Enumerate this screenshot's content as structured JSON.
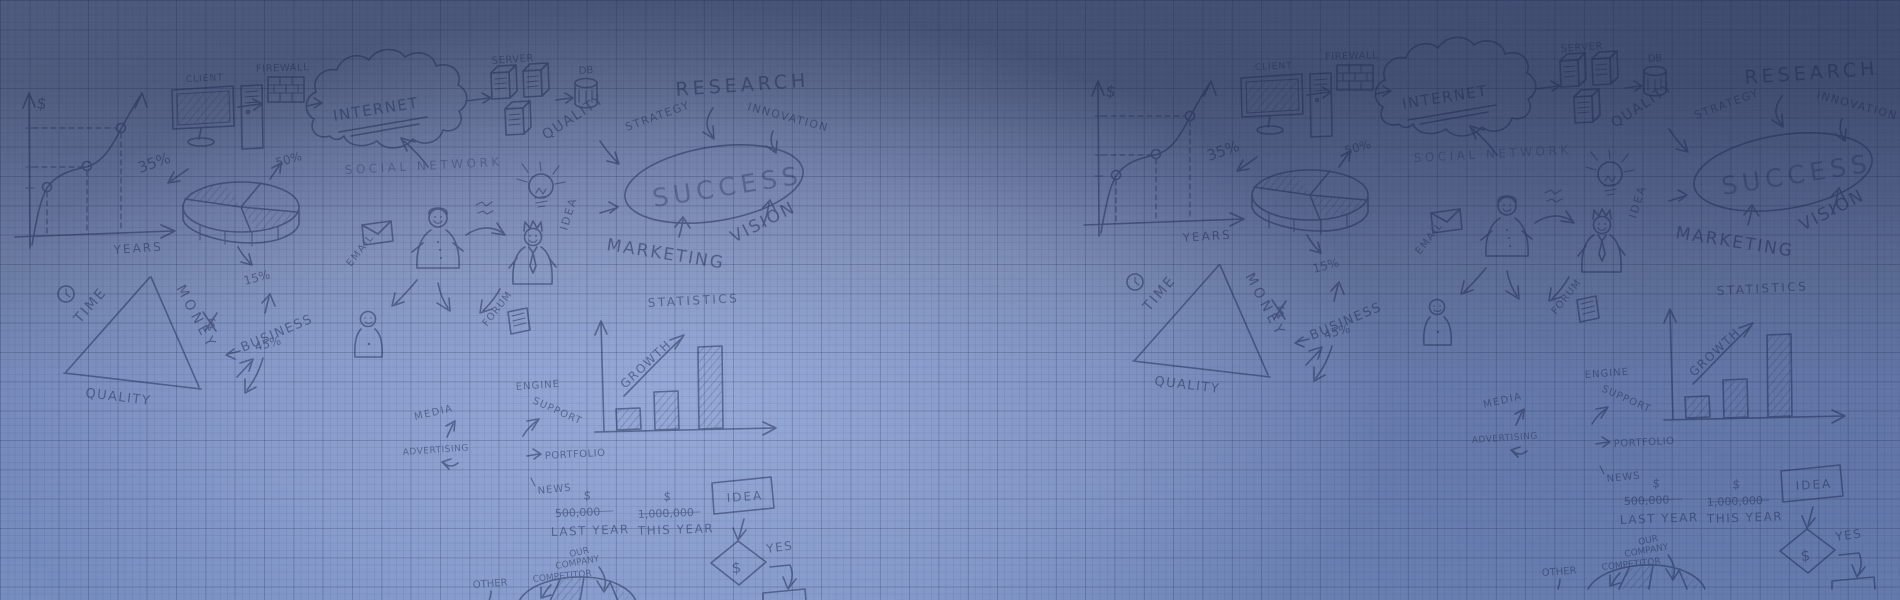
{
  "background": {
    "description": "blue graph-paper banner with hand-drawn business doodles, repeated twice",
    "colors": {
      "top": "#445177",
      "bottom": "#7089bd",
      "center_highlight": "#96a8d8",
      "grid_line": "#172142",
      "ink": "#1e2a52"
    }
  },
  "doodles": {
    "growth_chart": {
      "axis_y": "$",
      "axis_x": "YEARS",
      "pct35": "35%"
    },
    "network": {
      "client": "CLIENT",
      "firewall": "FIREWALL",
      "internet": "INTERNET",
      "server": "SERVER",
      "db": "DB",
      "social": "SOCIAL NETWORK",
      "pct50": "50%"
    },
    "concepts": {
      "quality": "QUALITY",
      "strategy": "STRATEGY",
      "research": "RESEARCH",
      "innovation": "INNOVATION",
      "success": "SUCCESS",
      "vision": "VISION",
      "marketing": "MARKETING"
    },
    "pie": {
      "pct15": "15%",
      "pct45": "45%"
    },
    "triangle": {
      "time": "TIME",
      "money": "MONEY",
      "quality": "QUALITY",
      "dollar": "$",
      "business": "BUSINESS"
    },
    "idea_bulb": {
      "idea": "IDEA"
    },
    "email": {
      "label": "EMAIL"
    },
    "forum": {
      "label": "FORUM"
    },
    "statistics": {
      "title": "STATISTICS",
      "growth": "GROWTH"
    },
    "channels": {
      "media": "MEDIA",
      "advertising": "ADVERTISING",
      "engine": "ENGINE",
      "support": "SUPPORT",
      "portfolio": "PORTFOLIO",
      "news": "NEWS"
    },
    "comparison": {
      "dollar_last": "$",
      "amount_last": "500,000",
      "label_last": "LAST YEAR",
      "dollar_this": "$",
      "amount_this": "1,000,000",
      "label_this": "THIS YEAR",
      "our_line1": "OUR",
      "our_line2": "COMPANY",
      "competitor": "COMPETITOR",
      "other": "OTHER"
    },
    "flow": {
      "idea": "IDEA",
      "dollar": "$",
      "yes": "YES"
    }
  }
}
